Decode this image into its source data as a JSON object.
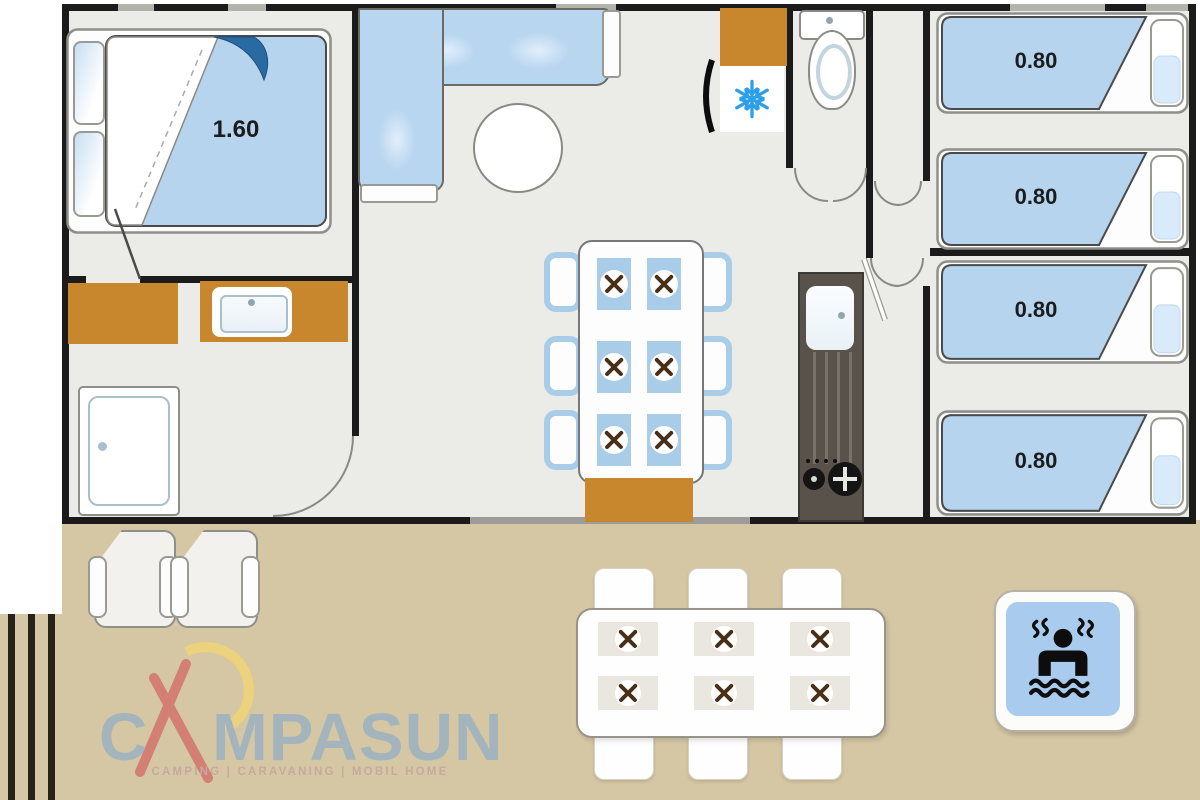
{
  "labels": {
    "double_bed": "1.60",
    "single_beds": [
      "0.80",
      "0.80",
      "0.80",
      "0.80"
    ]
  },
  "logo": {
    "letter_c": "C",
    "letters_rest": "MPASUN",
    "tagline": "CAMPING | CARAVANING | MOBIL HOME"
  },
  "colors": {
    "furniture_blue": "#b7d4ee",
    "counter_brown": "#c8872d",
    "terrace_tan": "#d5c7a4",
    "floor_gray": "#ebebe8",
    "wall_dark": "#1b1b1b",
    "kitchen_unit_dark": "#59524a",
    "snowflake_blue": "#2b9fe8",
    "pool_sign_blue": "#a9cbee",
    "logo_blue_gray": "#a3b4bd",
    "logo_red": "#d4736c",
    "logo_sun_yellow": "#ecd27c",
    "tagline_pink": "#c7a99e"
  },
  "icons": [
    "snowflake-icon",
    "toilet-icon",
    "sink-icon",
    "shower-icon",
    "stove-burners-icon",
    "cutlery-cross-icon",
    "jacuzzi-swimmer-icon",
    "tent-a-icon",
    "sun-icon"
  ]
}
